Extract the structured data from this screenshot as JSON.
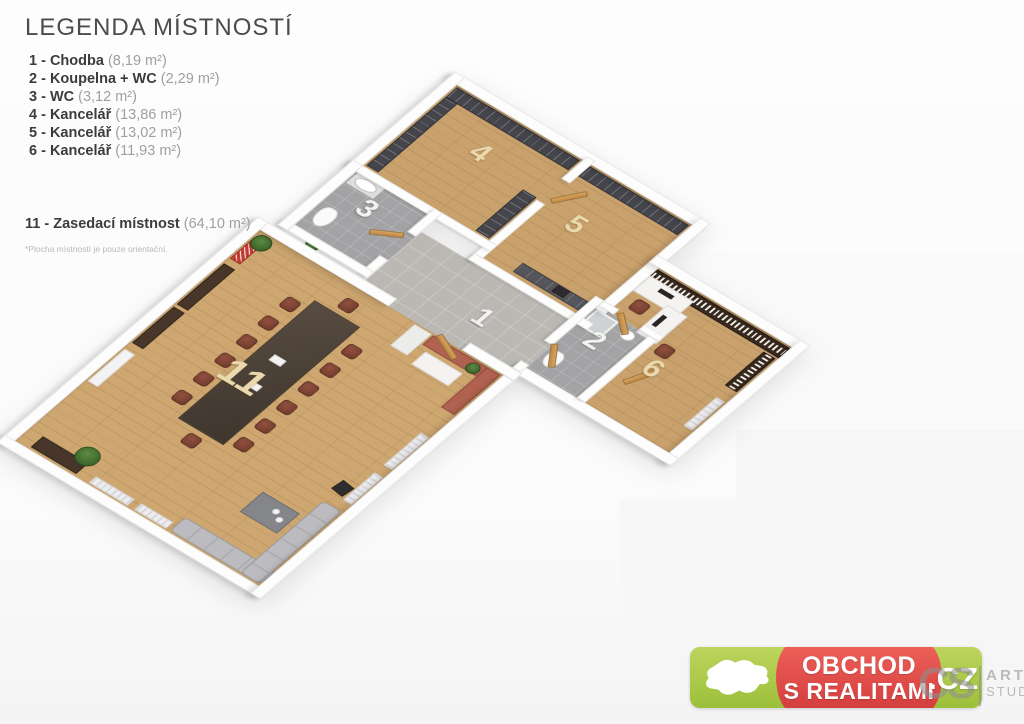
{
  "legend": {
    "title": "LEGENDA MÍSTNOSTÍ",
    "items": [
      {
        "label": "1 - Chodba",
        "area": "(8,19 m²)"
      },
      {
        "label": "2 - Koupelna + WC",
        "area": "(2,29 m²)"
      },
      {
        "label": "3 - WC",
        "area": "(3,12 m²)"
      },
      {
        "label": "4 - Kancelář",
        "area": "(13,86 m²)"
      },
      {
        "label": "5 - Kancelář",
        "area": "(13,02 m²)"
      },
      {
        "label": "6 - Kancelář",
        "area": "(11,93 m²)"
      }
    ],
    "item_meeting": {
      "label": "11 - Zasedací místnost",
      "area": "(64,10 m²)"
    },
    "footnote": "*Plocha místností je pouze orientační."
  },
  "floorplan": {
    "rooms": [
      {
        "label": "1",
        "name": "Chodba"
      },
      {
        "label": "2",
        "name": "Koupelna + WC"
      },
      {
        "label": "3",
        "name": "WC"
      },
      {
        "label": "4",
        "name": "Kancelář"
      },
      {
        "label": "5",
        "name": "Kancelář"
      },
      {
        "label": "6",
        "name": "Kancelář"
      },
      {
        "label": "11",
        "name": "Zasedací místnost"
      }
    ]
  },
  "badge": {
    "line1": "OBCHOD",
    "line2": "S REALITAMI",
    "tld": ".CZ"
  },
  "studio_watermark": {
    "initials": "CS",
    "line1": "ART",
    "line2": "STUDIO"
  },
  "colors": {
    "badge_green": "#a9c645",
    "badge_red": "#dd4743",
    "floor_wood": "#c9a16c",
    "floor_tile": "#b3b0ad",
    "wall_white": "#fdfdfd",
    "shelf_dark": "#45454c",
    "chair_red": "#7c4033",
    "label_cream": "#ead9ad"
  }
}
